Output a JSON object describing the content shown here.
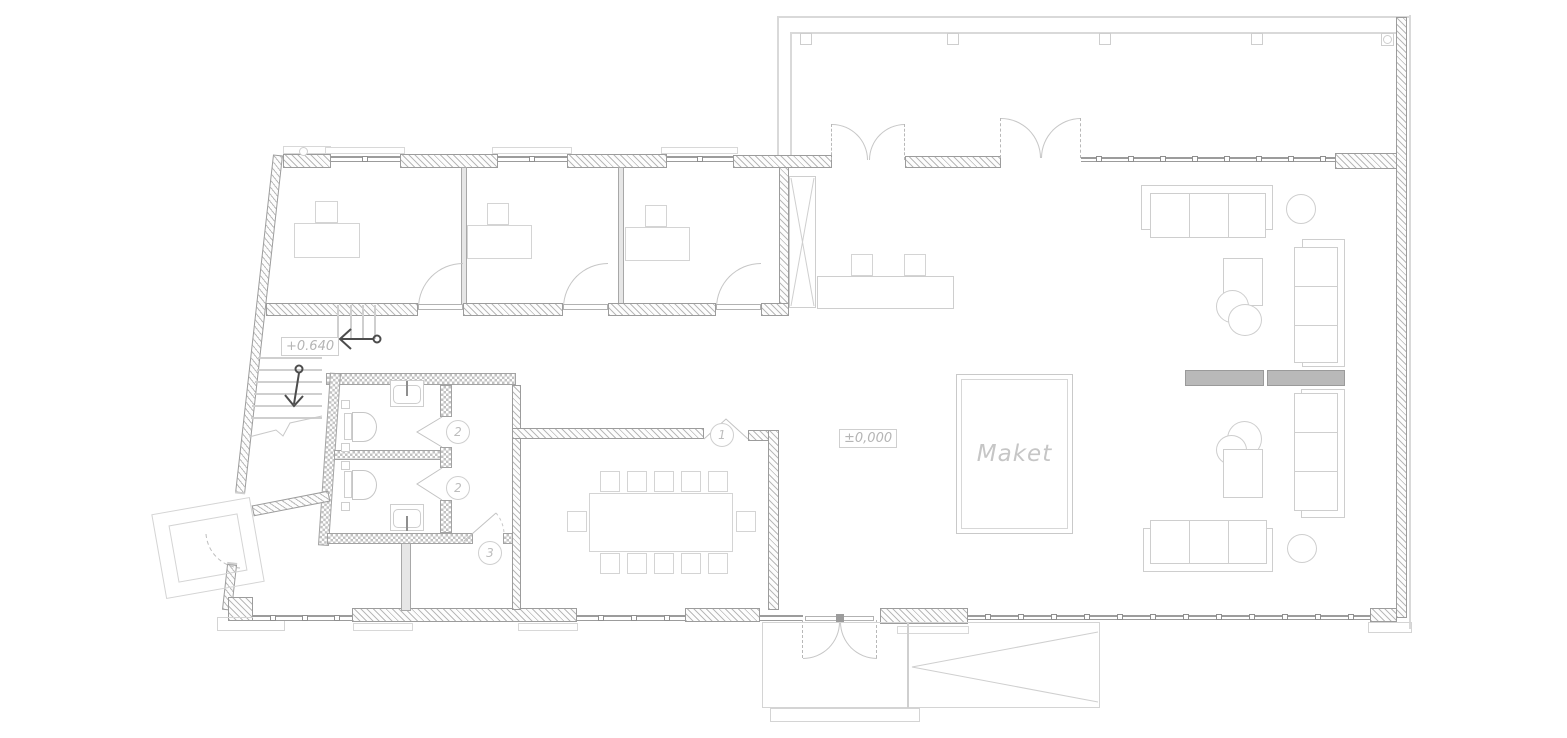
{
  "plan": {
    "labels": {
      "upper_level": "+0.640",
      "ground_level": "±0,000",
      "maket": "Maket"
    },
    "rooms": {
      "conference": "1",
      "wc_top": "2",
      "wc_bottom": "2",
      "storage": "3"
    },
    "colors": {
      "bg": "#ffffff",
      "wall": "#9c9c9c",
      "line": "#cfcfcf",
      "furniture": "#d4d4d4",
      "text": "#b5b5b5",
      "fill": "#b9b9b9",
      "arrow": "#4c4c4c"
    }
  }
}
